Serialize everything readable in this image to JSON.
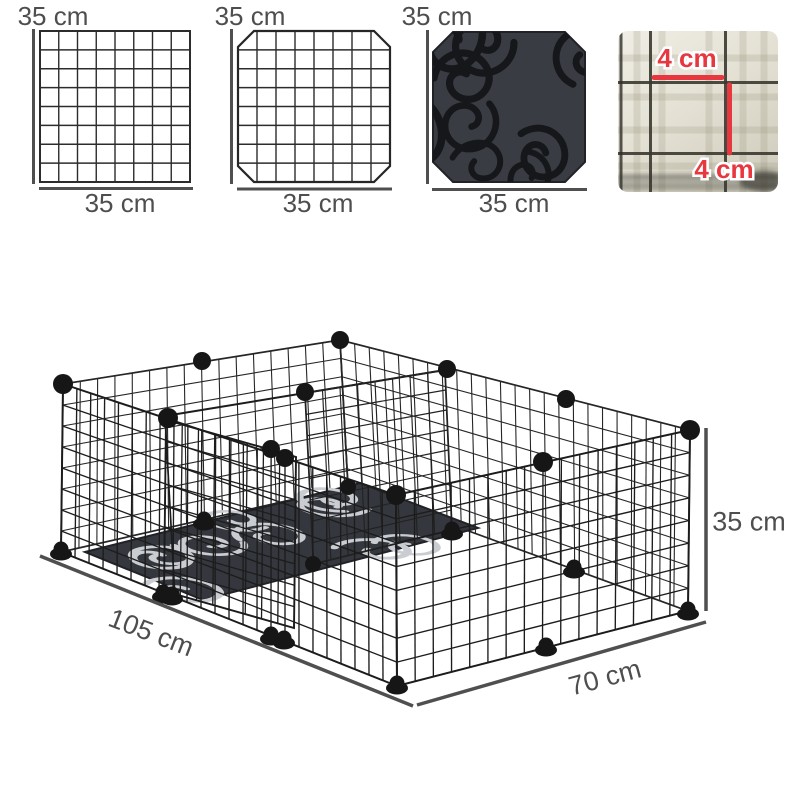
{
  "figures": [
    {
      "id": "wire-grid-panel",
      "top_label": "35 cm",
      "bottom_label": "35 cm"
    },
    {
      "id": "door-grid-panel",
      "top_label": "35 cm",
      "bottom_label": "35 cm"
    },
    {
      "id": "fabric-mat-panel",
      "top_label": "35 cm",
      "bottom_label": "35 cm"
    },
    {
      "id": "mesh-closeup",
      "horizontal_label": "4 cm",
      "vertical_label": "4 cm"
    }
  ],
  "playpen": {
    "length_label": "105 cm",
    "width_label": "70 cm",
    "height_label": "35 cm"
  },
  "colors": {
    "label_gray": "#4e4e4e",
    "dimension_red": "#e8383f",
    "wire_black": "#1c1c1c",
    "mat_dark": "#35383e",
    "photo_beige": "#e7e4d8"
  }
}
